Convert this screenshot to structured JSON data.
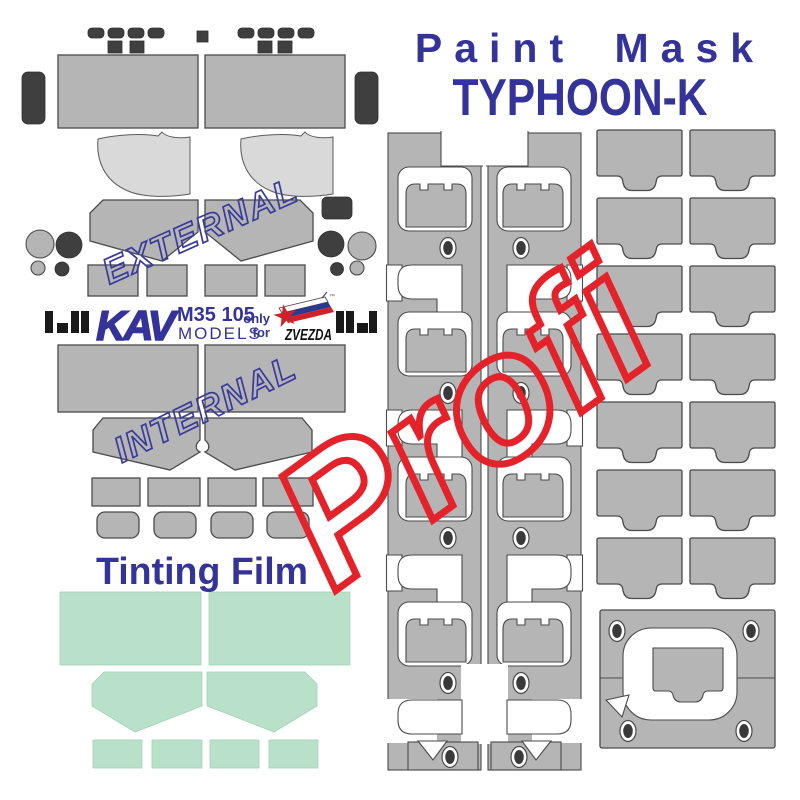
{
  "title": {
    "line1": "Paint Mask",
    "line2": "TYPHOON-K"
  },
  "stamps": {
    "external": "EXTERNAL",
    "internal": "INTERNAL",
    "profi": "Profi"
  },
  "brand": {
    "kav": "KAV",
    "code": "M35 105",
    "models": "MODELS",
    "only": "only",
    "for": "for",
    "zvezda": "ZVEZDA",
    "tm": "™",
    "star": "★"
  },
  "tinting": {
    "label": "Tinting Film"
  },
  "colors": {
    "brand_blue": "#343399",
    "stamp_blue": "#3a3a9c",
    "profi_red": "#e4222a",
    "mask_gray": "#b5b5b5",
    "light_gray": "#d9d9d9",
    "dark_gray": "#3f3f3f",
    "outline": "#4a4a4a",
    "tinting_mint": "#b9e1ca",
    "logo_flag_red": "#d0202a",
    "logo_flag_blue": "#2b3990",
    "background": "#ffffff"
  }
}
